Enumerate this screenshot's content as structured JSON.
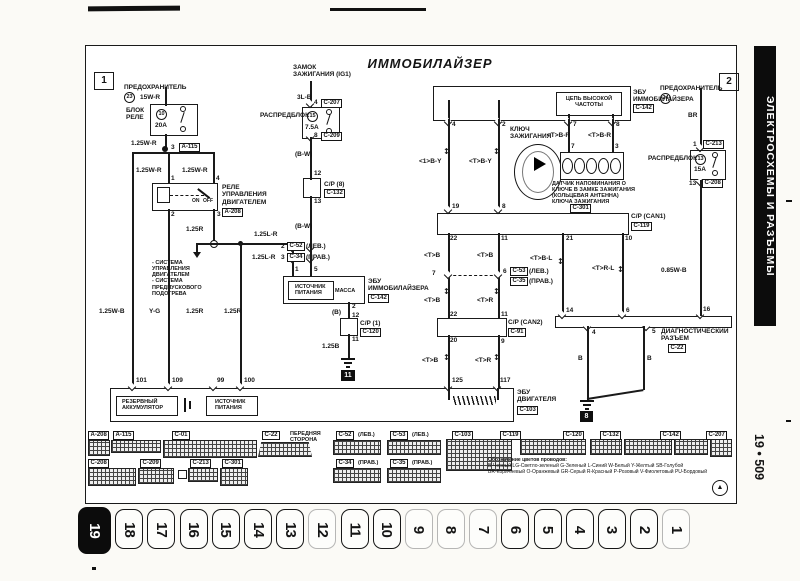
{
  "chrome": {
    "title": "ИММОБИЛАЙЗЕР",
    "side_tab": "ЭЛЕКТРОСХЕМЫ И РАЗЪЕМЫ",
    "page_ref": "19 • 509",
    "sec1": "1",
    "sec2": "2"
  },
  "icons": {
    "updown": "↕",
    "logo": "▲"
  },
  "tabs": [
    "19",
    "18",
    "17",
    "16",
    "15",
    "14",
    "13",
    "12",
    "11",
    "10",
    "9",
    "8",
    "7",
    "6",
    "5",
    "4",
    "3",
    "2",
    "1"
  ],
  "fuse_left": {
    "label": "ПРЕДОХРАНИТЕЛЬ",
    "fnum": "23",
    "w1": "15W-R",
    "block": "БЛОК\nРЕЛЕ",
    "circ": "10",
    "amp": "20A",
    "w2": "1.25W-R",
    "pin": "3",
    "tag": "A-115"
  },
  "relay": {
    "wl": "1.25W-R",
    "wr": "1.25W-R",
    "p1": "1",
    "p4": "4",
    "p2": "2",
    "p3": "3",
    "label": "РЕЛЕ\nУПРАВЛЕНИЯ\nДВИГАТЕЛЕМ",
    "tag": "A-208",
    "on": "ON",
    "off": "OFF",
    "out": "1.25R",
    "sys": "- СИСТЕМА\nУПРАВЛЕНИЯ\nДВИГАТЕЛЕМ\n- СИСТЕМА\nПРЕДПУСКОВОГО\nПОДОГРЕВА"
  },
  "feed": {
    "w": "1.25L-R",
    "p2": "2",
    "t2": "C-52",
    "s2": "(ЛЕВ.)",
    "w2": "1.25L-R",
    "p3": "3",
    "t3": "C-34",
    "s3": "(ПРАВ.)",
    "pin": "1"
  },
  "ign": {
    "label": "ЗАМОК\nЗАЖИГАНИЯ (IG1)",
    "w1": "3L-B",
    "p1": "4",
    "t1": "C-207",
    "block": "РАСПРЕДБЛОК",
    "circ": "15",
    "amp": "7.5A",
    "p2": "8",
    "t2": "C-209",
    "w2": "(B-W)",
    "p3": "12",
    "cp": "C/P (8)",
    "cpt": "C-132",
    "p4": "13",
    "w3": "(B-W)",
    "p5": "5"
  },
  "imb_low": {
    "label": "ЭБУ\nИММОБИЛАЙЗЕРА",
    "tag": "C-142",
    "src": "ИСТОЧНИК\nПИТАНИЯ",
    "massa": "МАССА",
    "p2": "2",
    "wb": "(B)",
    "p12": "12",
    "cp": "C/P (1)",
    "cpt": "C-120",
    "p11": "11",
    "w": "1.25B",
    "gnd": "11"
  },
  "ecu_eng": {
    "p101": "101",
    "p109": "109",
    "p99": "99",
    "p100": "100",
    "p125": "125",
    "p117": "117",
    "bat": "РЕЗЕРВНЫЙ\nАККУМУЛЯТОР",
    "src": "ИСТОЧНИК\nПИТАНИЯ",
    "label": "ЭБУ\nДВИГАТЕЛЯ",
    "tag": "C-103",
    "w1": "1.25W-B",
    "w2": "Y-G",
    "w3": "1.25R",
    "w4": "1.25R"
  },
  "imb_top": {
    "label": "ЭБУ\nИММОБИЛАЙЗЕРА",
    "tag": "C-142",
    "hf": "ЦЕПЬ ВЫСОКОЙ\nЧАСТОТЫ",
    "p4": "4",
    "p2": "2",
    "p7": "7",
    "p8": "8",
    "wa": "<1>B-Y",
    "wb": "<T>B-Y",
    "key": "КЛЮЧ\nЗАЖИГАНИЯ",
    "wr1": "<T>B-R",
    "wr2": "<T>B-R",
    "sp7": "7",
    "sp3": "3",
    "sensor": "ДАТЧИК НАПОМИНАНИЯ О\nКЛЮЧЕ В ЗАМКЕ ЗАЖИГАНИЯ\n(КОЛЬЦЕВАЯ АНТЕННА)\nКЛЮЧА ЗАЖИГАНИЯ",
    "stag": "C-301"
  },
  "fuse_right": {
    "label": "ПРЕДОХРАНИТЕЛЬ",
    "fnum": "24",
    "w1": "BR",
    "p1": "1",
    "t1": "C-213",
    "block": "РАСПРЕДБЛОК",
    "circ": "13",
    "amp": "15A",
    "p2": "13",
    "t2": "C-208",
    "w2": "0.85W-B",
    "p3": "16"
  },
  "can": {
    "p19": "19",
    "p8": "8",
    "cp1": "C/P (CAN1)",
    "cp1t": "C-119",
    "p22a": "22",
    "p11a": "11",
    "p21": "21",
    "p10": "10",
    "wa1": "<T>B",
    "wb1": "<T>B",
    "wbl": "<T>B-L",
    "wrl": "<T>R-L",
    "j7": "7",
    "j6": "6",
    "jt": "C-53",
    "js": "(ЛЕВ.)",
    "jt2": "C-35",
    "js2": "(ПРАВ.)",
    "wa2": "<T>B",
    "wb2": "<T>R",
    "p22b": "22",
    "p11b": "11",
    "cp2": "C/P (CAN2)",
    "cp2t": "C-91",
    "p20": "20",
    "p9": "9",
    "wa3": "<T>B",
    "wb3": "<T>R",
    "p14": "14",
    "p6": "6"
  },
  "diag": {
    "p4": "4",
    "p5": "5",
    "label": "ДИАГНОСТИЧЕСКИЙ\nРАЗЪЕМ",
    "tag": "C-22",
    "wl": "B",
    "wr": "B",
    "gnd": "8"
  },
  "strip": {
    "r1": [
      {
        "tag": "A-208",
        "note": ""
      },
      {
        "tag": "A-115",
        "note": ""
      },
      {
        "tag": "C-01",
        "note": ""
      },
      {
        "tag": "C-22",
        "note": "ПЕРЕДНЯЯ\nСТОРОНА"
      },
      {
        "tag": "C-52",
        "note": "(ЛЕВ.)"
      },
      {
        "tag": "C-53",
        "note": "(ЛЕВ.)"
      },
      {
        "tag": "C-103",
        "note": ""
      },
      {
        "tag": "C-119",
        "note": ""
      },
      {
        "tag": "C-120",
        "note": ""
      },
      {
        "tag": "C-132",
        "note": ""
      },
      {
        "tag": "C-142",
        "note": ""
      },
      {
        "tag": "C-207",
        "note": ""
      }
    ],
    "r2": [
      {
        "tag": "C-208",
        "note": ""
      },
      {
        "tag": "C-209",
        "note": ""
      },
      {
        "tag": "C-213",
        "note": ""
      },
      {
        "tag": "C-301",
        "note": ""
      },
      {
        "tag": "C-34",
        "note": "(ПРАВ.)"
      },
      {
        "tag": "C-35",
        "note": "(ПРАВ.)"
      }
    ]
  },
  "legend": {
    "t": "Обозначение цветов проводов:",
    "l1": "В-Черный  LG-Светло-зеленый  G-Зеленый  L-Синий  W-Белый  Y-Желтый  SB-Голубой",
    "l2": "BR-Коричневый  O-Оранжевый  GR-Серый  R-Красный  P-Розовый  V-Фиолетовый  PU-Бордовый"
  }
}
